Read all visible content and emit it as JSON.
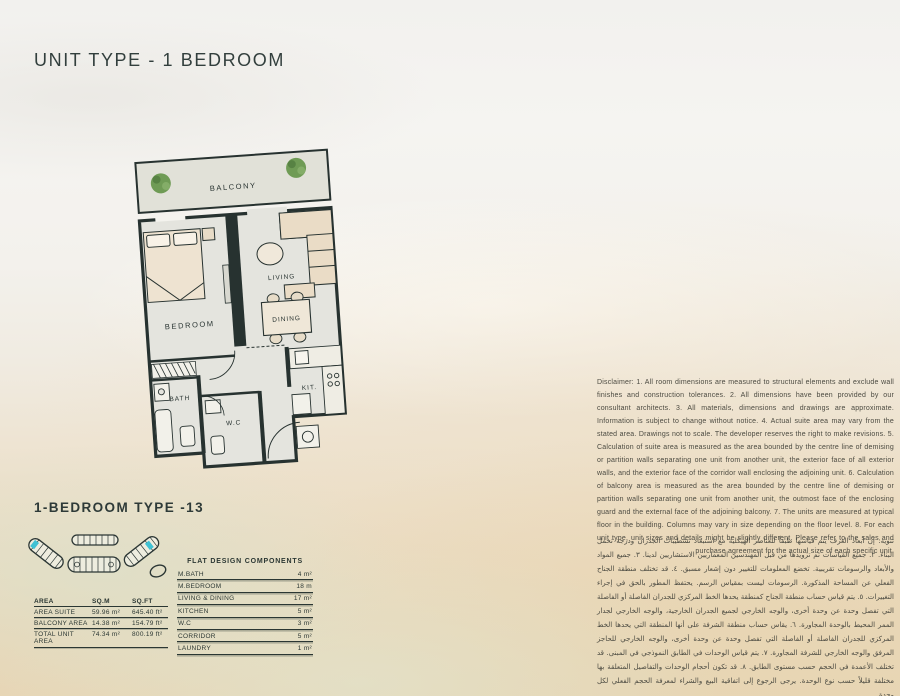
{
  "page": {
    "title": "UNIT TYPE - 1 BEDROOM",
    "type_title": "1-BEDROOM TYPE -13"
  },
  "floor_plan": {
    "labels": {
      "balcony": "BALCONY",
      "bedroom": "BEDROOM",
      "living": "LIVING",
      "dining": "DINING",
      "bath": "BATH",
      "wc": "W.C",
      "kitchen": "KIT."
    }
  },
  "area_table": {
    "headers": [
      "AREA",
      "SQ.M",
      "SQ.FT"
    ],
    "rows": [
      {
        "label": "AREA SUITE",
        "sqm": "59.96 m²",
        "sqft": "645.40 ft²"
      },
      {
        "label": "BALCONY AREA",
        "sqm": "14.38 m²",
        "sqft": "154.79 ft²"
      },
      {
        "label": "TOTAL UNIT AREA",
        "sqm": "74.34 m²",
        "sqft": "800.19 ft²"
      }
    ]
  },
  "components_table": {
    "title": "FLAT DESIGN COMPONENTS",
    "rows": [
      {
        "label": "M.BATH",
        "value": "4 m²"
      },
      {
        "label": "M.BEDROOM",
        "value": "18 m"
      },
      {
        "label": "LIVING & DINING",
        "value": "17 m²"
      },
      {
        "label": "KITCHEN",
        "value": "5 m²"
      },
      {
        "label": "W.C",
        "value": "3 m²"
      },
      {
        "label": "CORRIDOR",
        "value": "5 m²"
      },
      {
        "label": "LAUNDRY",
        "value": "1 m²"
      }
    ]
  },
  "disclaimer_en": "Disclaimer: 1. All room dimensions are measured to structural elements and exclude wall finishes and construction tolerances. 2. All dimensions have been provided by our consultant architects. 3. All materials, dimensions and drawings are approximate. Information is subject to change without notice. 4. Actual suite area may vary from the stated area. Drawings not to scale. The developer reserves the right to make revisions. 5. Calculation of suite area is measured as the area bounded by the centre line of demising or partition walls separating one unit from another unit, the exterior face of all exterior walls, and the exterior face of the corridor wall enclosing the adjoining unit. 6. Calculation of balcony area is measured as the area bounded by the centre line of demising or partition walls separating one unit from another unit, the outmost face of the enclosing guard and the external face of the adjoining balcony. 7. The units are measured at typical floor in the building. Columns may vary in size depending on the floor level. 8. For each unit type, unit sizes and details might be slightly different. Please refer to the sales and purchase agreement for the actual size of each specific unit.",
  "disclaimer_ar": "تنويه: إن أبعاد الغرف يتم قياسها طبقاً للعناصر الهيكلية مع استبعاد تشطيبات الجدران ودرجة تحمل البناء. ٢. جميع القياسات تم تزويدها من قبل المهندسين المعماريين الاستشاريين لدينا. ٣. جميع المواد والأبعاد والرسومات تقريبية. تخضع المعلومات للتغيير دون إشعار مسبق. ٤. قد تختلف منطقة الجناح الفعلي عن المساحة المذكورة. الرسومات ليست بمقياس الرسم. يحتفظ المطور بالحق في إجراء التغييرات. ٥. يتم قياس حساب منطقة الجناح كمنطقة يحدها الخط المركزي للجدران الفاصلة أو الفاصلة التي تفصل وحدة عن وحدة أخرى، والوجه الخارجي لجميع الجدران الخارجية، والوجه الخارجي لجدار الممر المحيط بالوحدة المجاورة. ٦. يقاس حساب منطقة الشرفة على أنها المنطقة التي يحدها الخط المركزي للجدران الفاصلة أو الفاصلة التي تفصل وحدة عن وحدة أخرى، والوجه الخارجي للحاجز المرفق والوجه الخارجي للشرفة المجاورة. ٧. يتم قياس الوحدات في الطابق النموذجي في المبنى. قد تختلف الأعمدة في الحجم حسب مستوى الطابق. ٨. قد تكون أحجام الوحدات والتفاصيل المتعلقة بها مختلفة قليلاً حسب نوع الوحدة. يرجى الرجوع إلى اتفاقية البيع والشراء لمعرفة الحجم الفعلي لكل وحدة.",
  "colors": {
    "ink": "#2b3733",
    "wall": "#273230",
    "accent_cyan": "#3fc1d4",
    "sand": "#e9d9bc",
    "seafoam": "#dfe7d8"
  }
}
